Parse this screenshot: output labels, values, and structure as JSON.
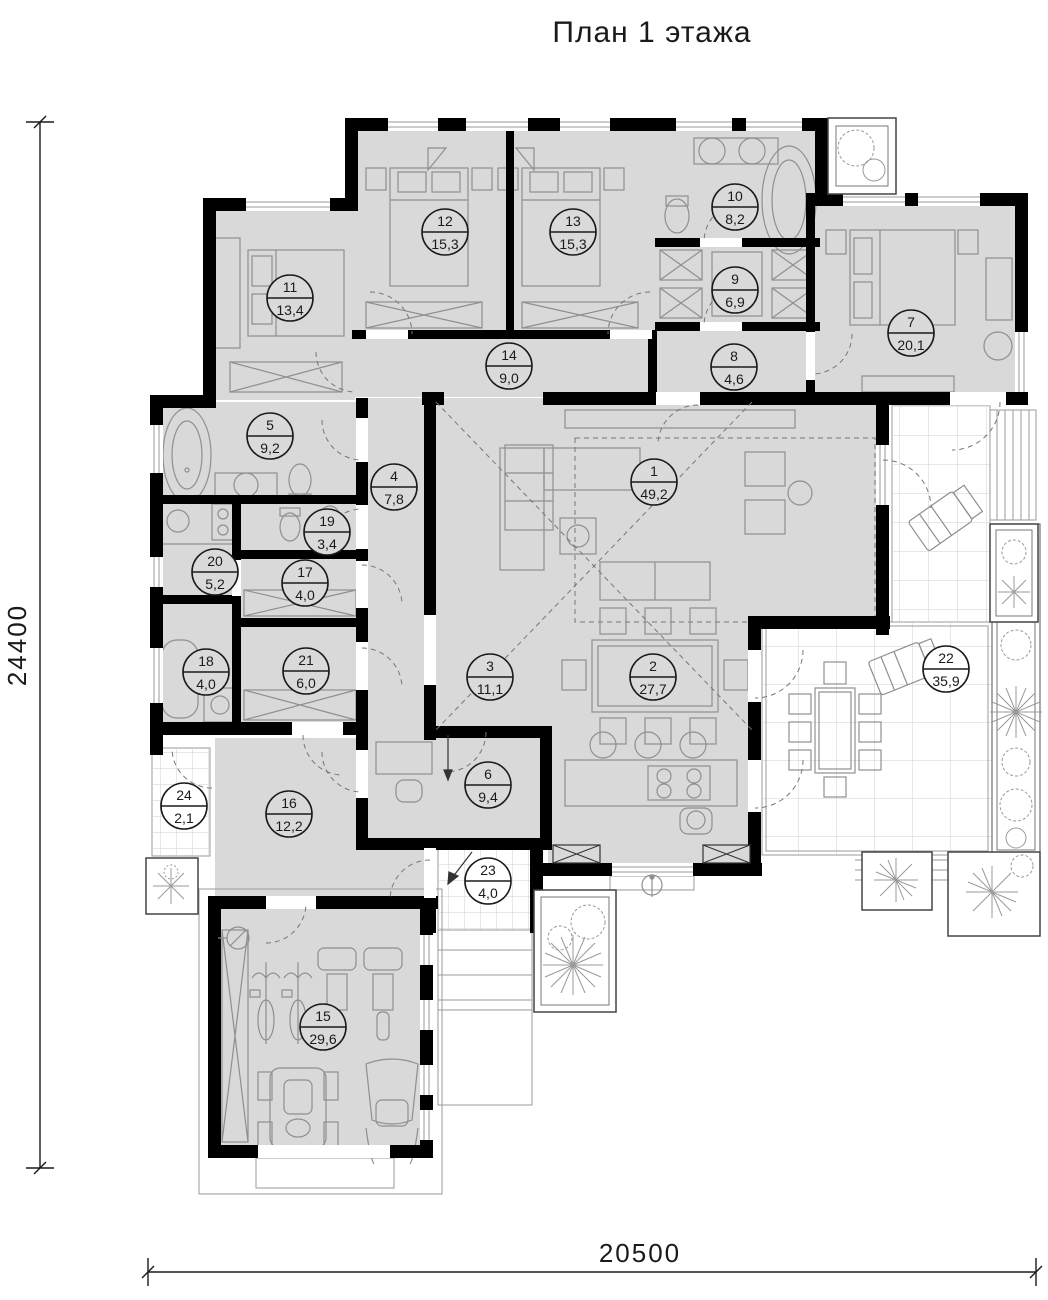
{
  "title": "План 1 этажа",
  "dimensions": {
    "left_vertical": "24400",
    "bottom_horizontal": "20500"
  },
  "colors": {
    "wall": "#000000",
    "room_fill": "#d9d9d9",
    "furniture_line": "#8f8f8f",
    "tile_line": "#cfcfcf",
    "label_stroke": "#1a1a1a"
  },
  "rooms": [
    {
      "number": "1",
      "area": "49,2",
      "cx": 654,
      "cy": 482,
      "outdoor": false
    },
    {
      "number": "2",
      "area": "27,7",
      "cx": 653,
      "cy": 677,
      "outdoor": false
    },
    {
      "number": "3",
      "area": "11,1",
      "cx": 490,
      "cy": 677,
      "outdoor": false
    },
    {
      "number": "4",
      "area": "7,8",
      "cx": 394,
      "cy": 487,
      "outdoor": false
    },
    {
      "number": "5",
      "area": "9,2",
      "cx": 270,
      "cy": 436,
      "outdoor": false
    },
    {
      "number": "6",
      "area": "9,4",
      "cx": 488,
      "cy": 785,
      "outdoor": false
    },
    {
      "number": "7",
      "area": "20,1",
      "cx": 911,
      "cy": 333,
      "outdoor": false
    },
    {
      "number": "8",
      "area": "4,6",
      "cx": 734,
      "cy": 367,
      "outdoor": false
    },
    {
      "number": "9",
      "area": "6,9",
      "cx": 735,
      "cy": 290,
      "outdoor": false
    },
    {
      "number": "10",
      "area": "8,2",
      "cx": 735,
      "cy": 207,
      "outdoor": false
    },
    {
      "number": "11",
      "area": "13,4",
      "cx": 290,
      "cy": 298,
      "outdoor": false
    },
    {
      "number": "12",
      "area": "15,3",
      "cx": 445,
      "cy": 232,
      "outdoor": false
    },
    {
      "number": "13",
      "area": "15,3",
      "cx": 573,
      "cy": 232,
      "outdoor": false
    },
    {
      "number": "14",
      "area": "9,0",
      "cx": 509,
      "cy": 366,
      "outdoor": false
    },
    {
      "number": "15",
      "area": "29,6",
      "cx": 323,
      "cy": 1027,
      "outdoor": false
    },
    {
      "number": "16",
      "area": "12,2",
      "cx": 289,
      "cy": 814,
      "outdoor": false
    },
    {
      "number": "17",
      "area": "4,0",
      "cx": 305,
      "cy": 583,
      "outdoor": false
    },
    {
      "number": "18",
      "area": "4,0",
      "cx": 206,
      "cy": 672,
      "outdoor": false
    },
    {
      "number": "19",
      "area": "3,4",
      "cx": 327,
      "cy": 532,
      "outdoor": false
    },
    {
      "number": "20",
      "area": "5,2",
      "cx": 215,
      "cy": 572,
      "outdoor": false
    },
    {
      "number": "21",
      "area": "6,0",
      "cx": 306,
      "cy": 671,
      "outdoor": false
    },
    {
      "number": "22",
      "area": "35,9",
      "cx": 946,
      "cy": 669,
      "outdoor": true
    },
    {
      "number": "23",
      "area": "4,0",
      "cx": 488,
      "cy": 881,
      "outdoor": true
    },
    {
      "number": "24",
      "area": "2,1",
      "cx": 184,
      "cy": 806,
      "outdoor": true
    }
  ]
}
